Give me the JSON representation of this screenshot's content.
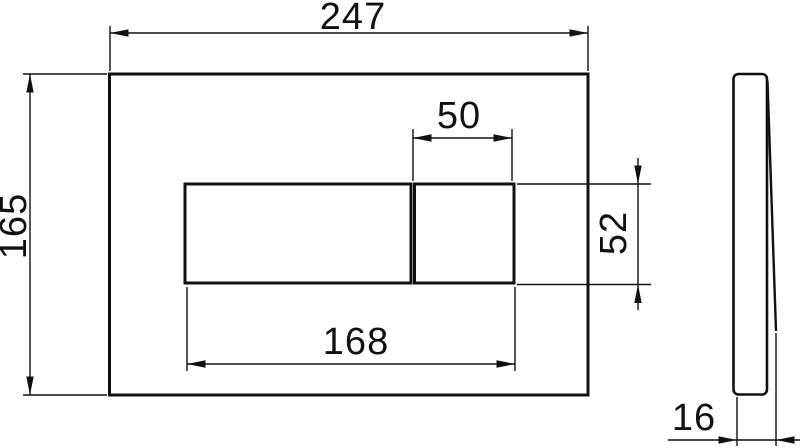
{
  "page": {
    "background_color": "#ffffff",
    "line_color": "#111111"
  },
  "drawing": {
    "kind": "technical dimension drawing of wall flush plate with two buttons",
    "views": [
      {
        "id": "front",
        "name": "front view of plate with large and small button"
      },
      {
        "id": "side",
        "name": "side profile view of plate"
      }
    ],
    "dimensions": {
      "plate_width": "247",
      "plate_height": "165",
      "small_button_width": "50",
      "button_height": "52",
      "buttons_total_width": "168",
      "plate_thickness": "16"
    }
  }
}
